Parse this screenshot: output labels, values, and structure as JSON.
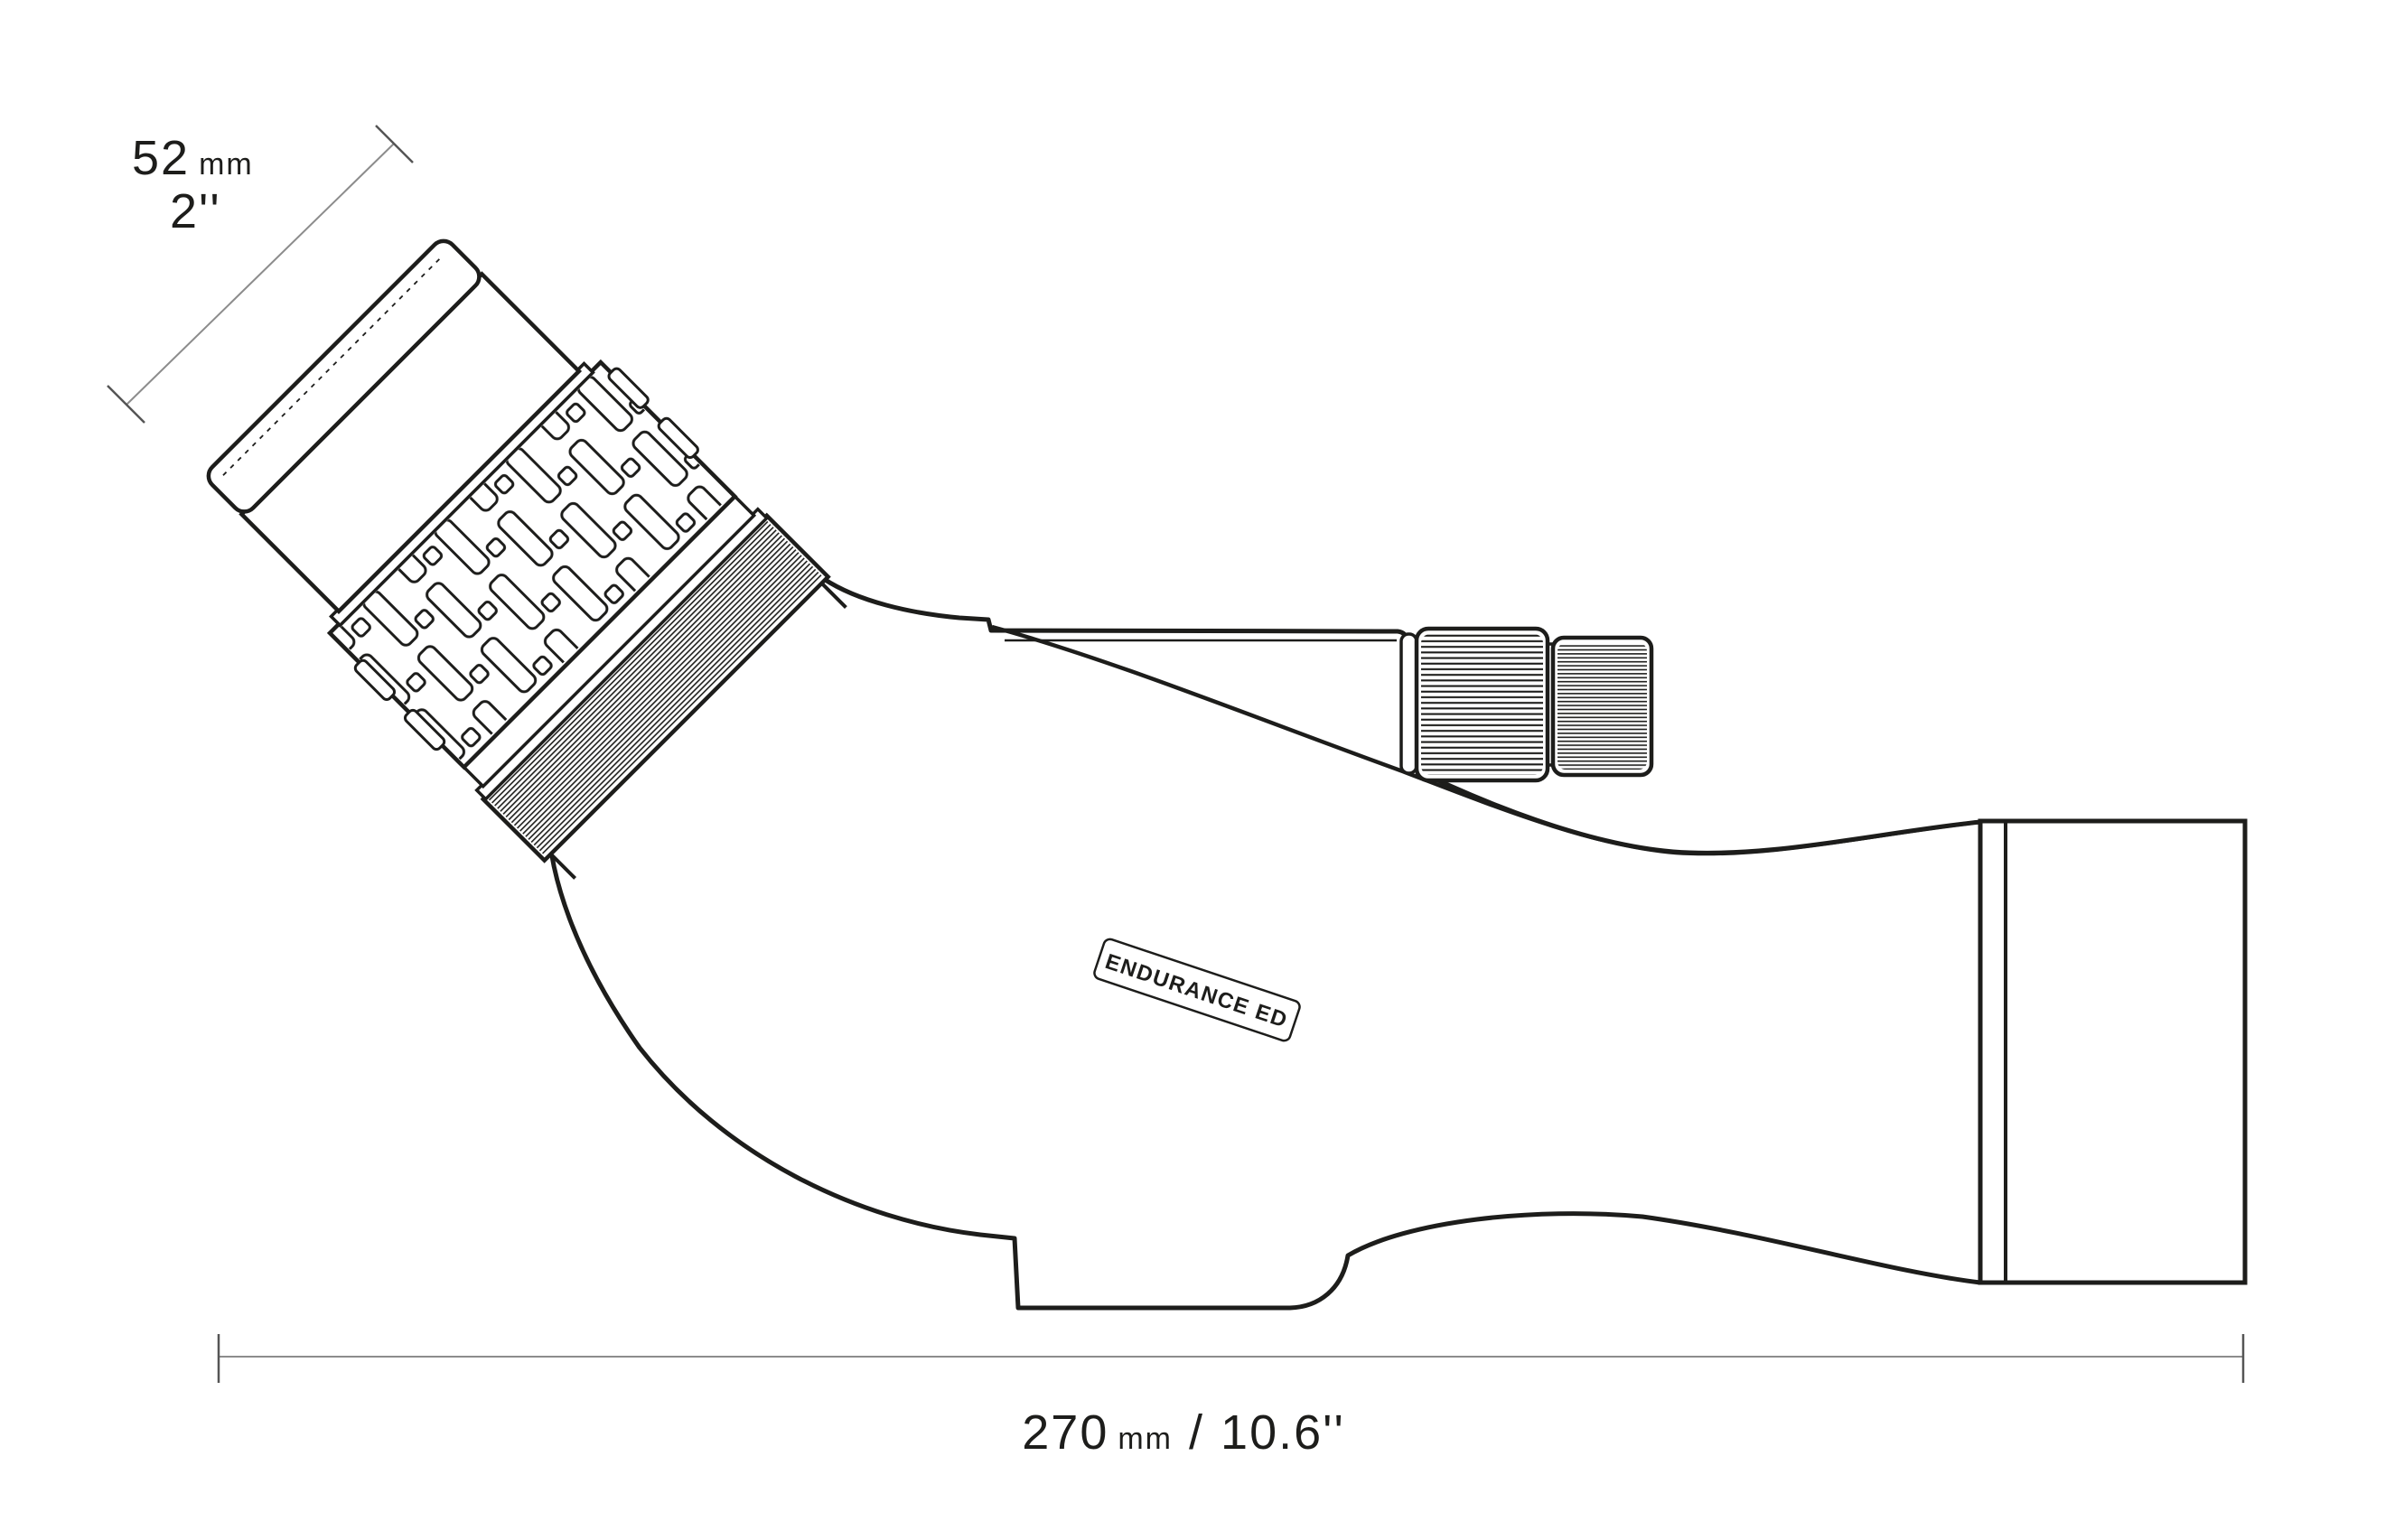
{
  "diagram": {
    "badge": {
      "label": "ENDURANCE ED"
    },
    "eyepiece_dimension": {
      "metric": "52",
      "metric_unit": "mm",
      "imperial": "2''"
    },
    "length_dimension": {
      "metric": "270",
      "metric_unit": "mm",
      "separator": "/",
      "imperial": "10.6''"
    },
    "colors": {
      "line": "#1d1d1b",
      "dimension_line": "#8c8c8c",
      "dimension_tick": "#555555",
      "text": "#1d1d1b",
      "background": "#ffffff"
    }
  }
}
